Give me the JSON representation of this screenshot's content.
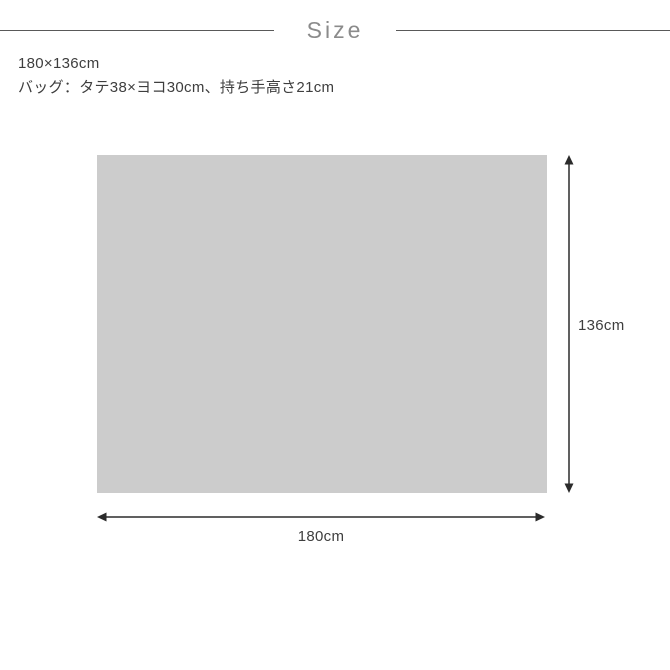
{
  "header": {
    "title": "Size"
  },
  "description": {
    "line1": "180×136cm",
    "line2": "バッグ：タテ38×ヨコ30cm、持ち手高さ21cm"
  },
  "diagram": {
    "rect_color": "#cccccc",
    "arrow_color": "#2b2b2b",
    "width_label": "180cm",
    "height_label": "136cm"
  }
}
